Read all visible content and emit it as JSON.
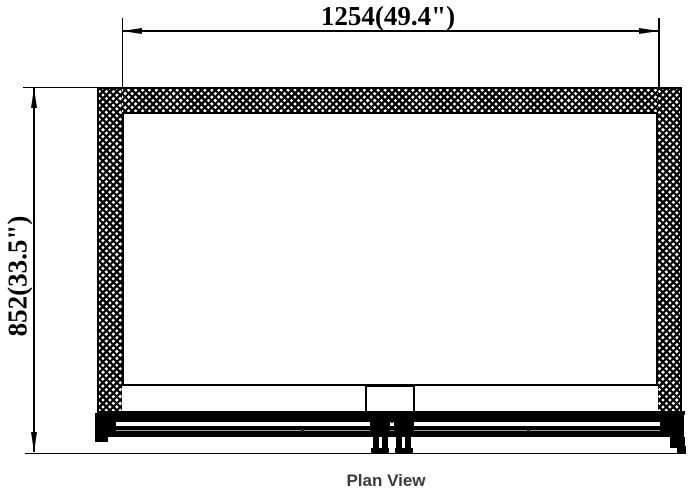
{
  "drawing": {
    "caption": "Plan View",
    "width_dimension_label": "1254(49.4\")",
    "height_dimension_label": "852(33.5\")"
  },
  "colors": {
    "line": "#000000",
    "hatch": "#000000",
    "caption_text": "#3a3a3a",
    "background": "#ffffff"
  }
}
